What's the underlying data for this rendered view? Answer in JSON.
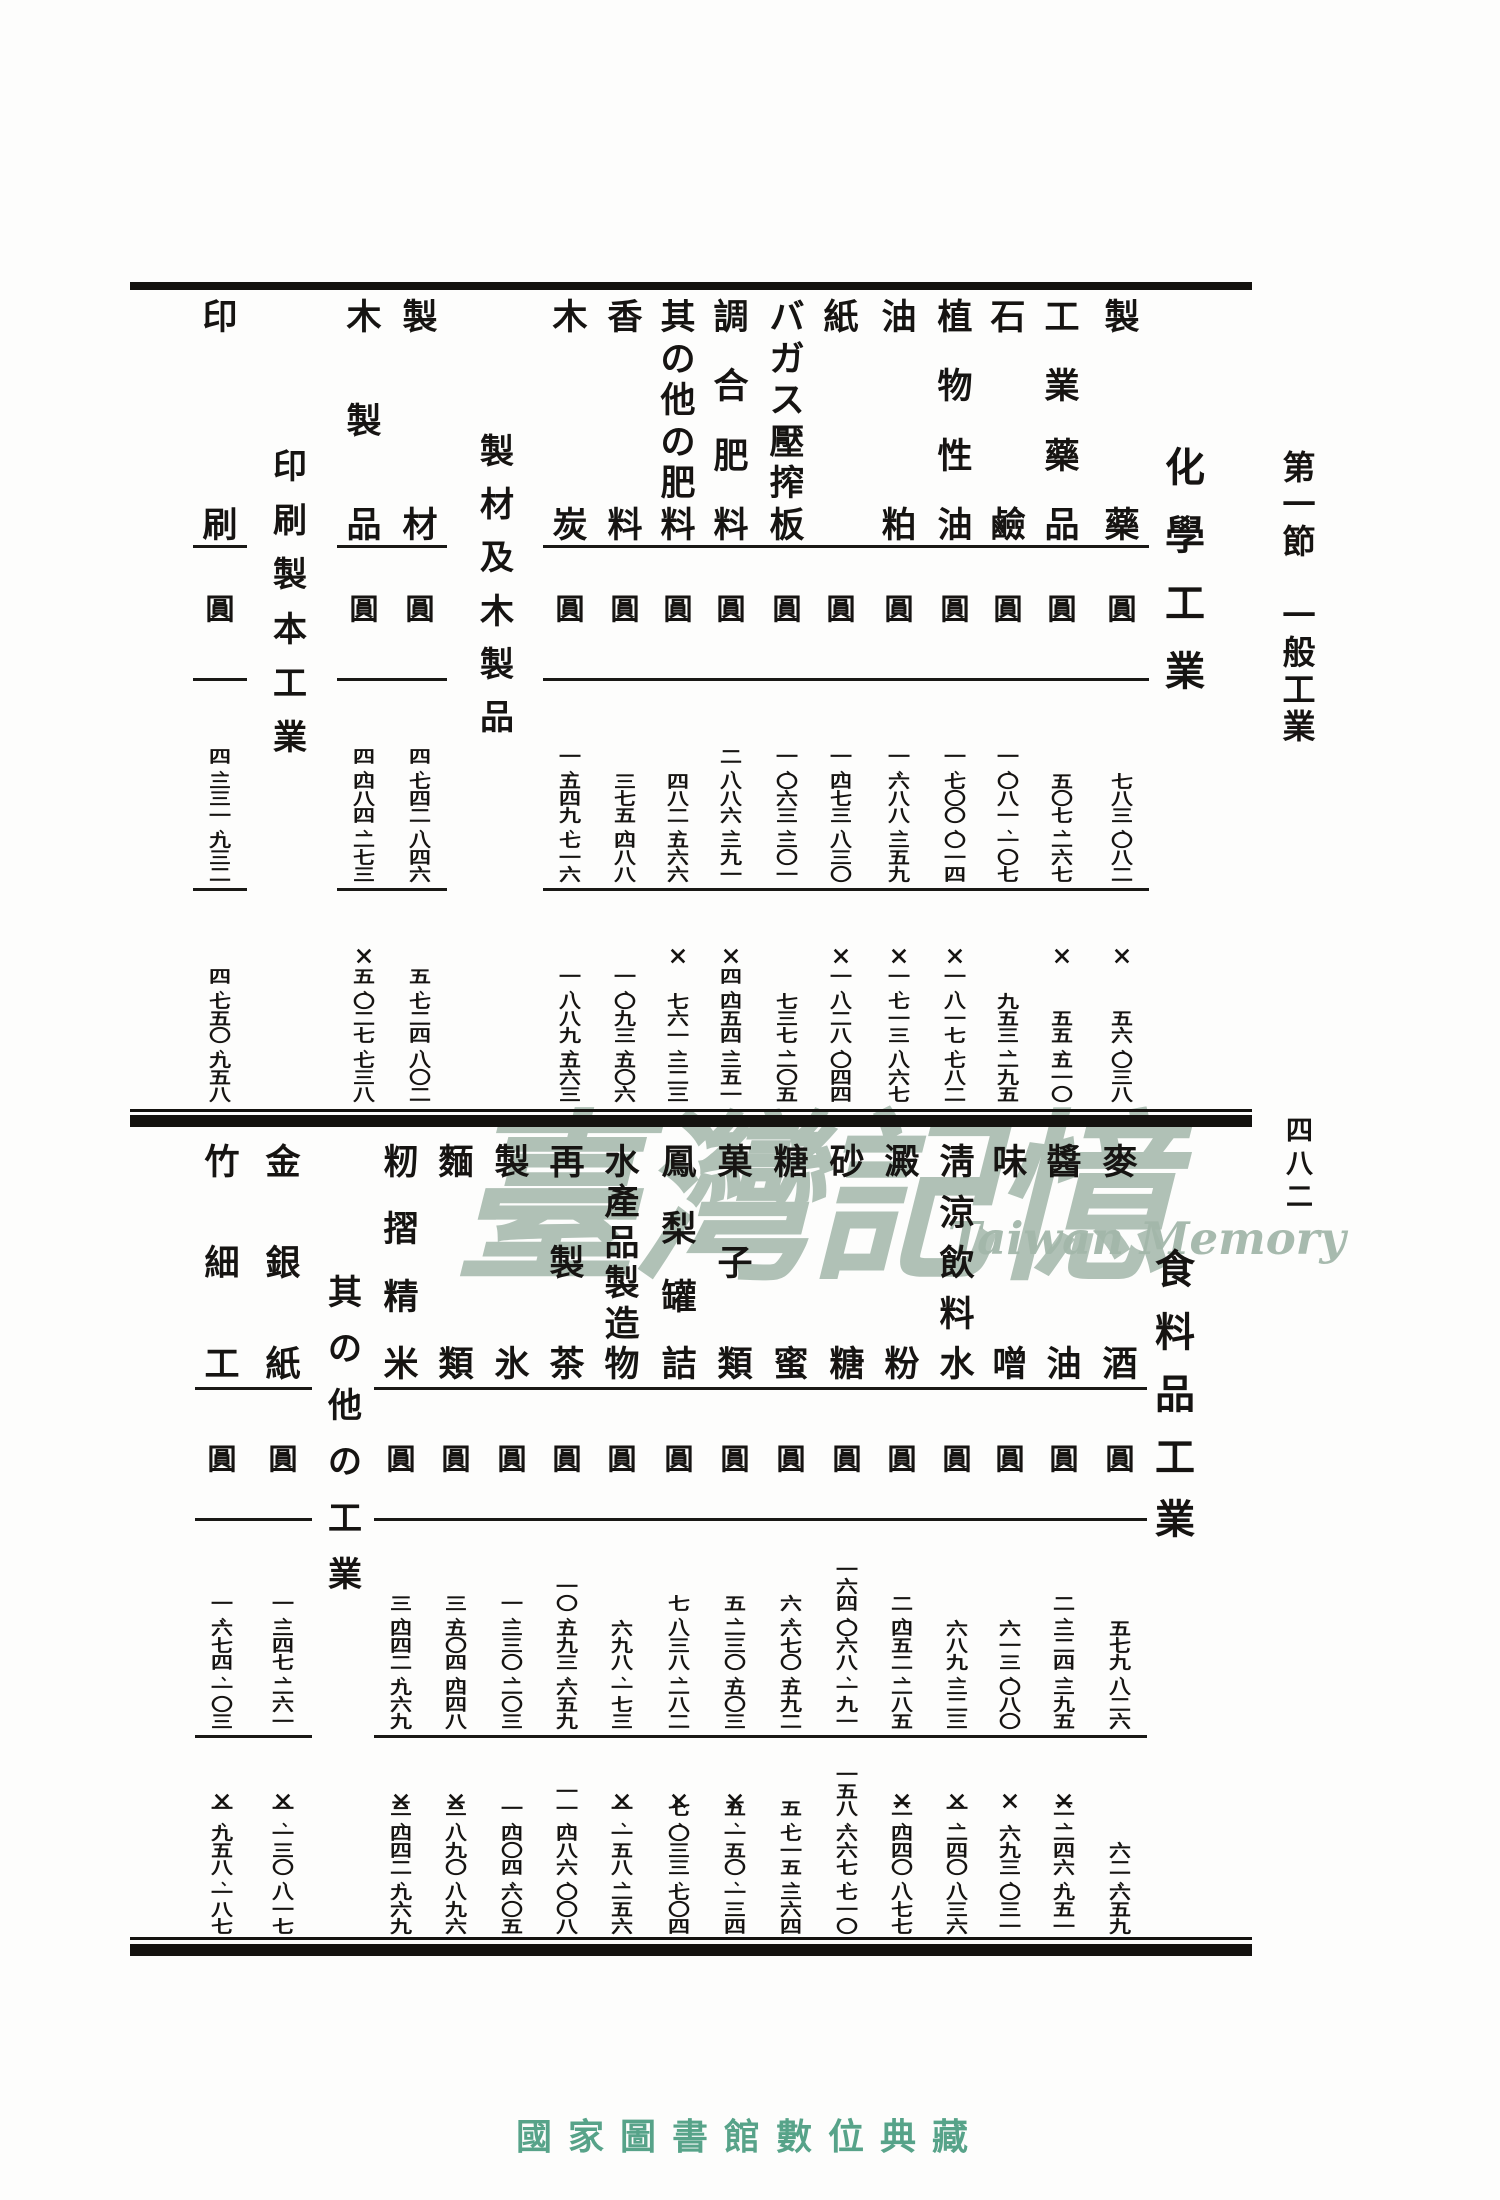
{
  "page": {
    "section_heading": "第一節　一般工業",
    "page_number": "四八二",
    "watermark": {
      "chars": "臺灣記憶",
      "latin": "Taiwan Memory"
    },
    "footer": "國家圖書館數位典藏",
    "unit": "圓",
    "x_symbol": "×",
    "accent_green": "#57a389",
    "watermark_green": "#a3b7aa"
  },
  "tables": [
    {
      "industry_label": "化學工業",
      "columns": [
        {
          "type": "data",
          "label": "製藥",
          "row1": "七八三、〇八二",
          "row2": "五六、〇三八",
          "row2_x": true
        },
        {
          "type": "data",
          "label": "工業藥品",
          "row1": "五〇七、二六七",
          "row2": "五五、五一〇",
          "row2_x": true
        },
        {
          "type": "data",
          "label": "石鹼",
          "row1": "一、〇八一、一〇七",
          "row2": "九五三、二九五",
          "row2_x": false
        },
        {
          "type": "data",
          "label": "植物性油",
          "row1": "一、七〇〇、〇一四",
          "row2": "一、八一七、七八二",
          "row2_x": true
        },
        {
          "type": "data",
          "label": "油粕",
          "row1": "一、六八八、三五九",
          "row2": "一、七一三、八六七",
          "row2_x": true
        },
        {
          "type": "data",
          "label": "紙",
          "row1": "一、四七三、八三〇",
          "row2": "一、八二八、〇四四",
          "row2_x": true
        },
        {
          "type": "data",
          "label": "バガス壓搾板",
          "row1": "一、〇六三、三〇一",
          "row2": "七三七、二〇五",
          "row2_x": false
        },
        {
          "type": "data",
          "label": "調合肥料",
          "row1": "二、八八六、三九一",
          "row2": "四、四五四、三五一",
          "row2_x": true
        },
        {
          "type": "data",
          "label": "其の他の肥料",
          "row1": "四八二、五六六",
          "row2": "七六一、三二三",
          "row2_x": true
        },
        {
          "type": "data",
          "label": "香料",
          "row1": "三七五、四八八",
          "row2": "一、〇九三、五〇六",
          "row2_x": false
        },
        {
          "type": "data",
          "label": "木炭",
          "row1": "一、五四九、七一六",
          "row2": "一、八八九、五六三",
          "row2_x": false
        },
        {
          "type": "group",
          "label": "製材及木製品"
        },
        {
          "type": "data",
          "label": "製材",
          "row1": "四、七四二、八四六",
          "row2": "五、七二四、八〇二",
          "row2_x": false
        },
        {
          "type": "data",
          "label": "木製品",
          "row1": "四、四八四、二七三",
          "row2": "五、〇二七、七三八",
          "row2_x": true
        },
        {
          "type": "group",
          "label": "印刷製本工業"
        },
        {
          "type": "data",
          "label": "印刷",
          "row1": "四、三三一、九三二",
          "row2": "四、七五〇、九五八",
          "row2_x": false
        }
      ]
    },
    {
      "industry_label": "食料品工業",
      "columns": [
        {
          "type": "data",
          "label": "麥酒",
          "row1": "五七九、八二六",
          "row2": "六二、六五九",
          "row2_x": false
        },
        {
          "type": "data",
          "label": "醬油",
          "row1": "二、三二四、三九五",
          "row2": "二、二四六、九五一",
          "row2_x": true
        },
        {
          "type": "data",
          "label": "味噌",
          "row1": "六一三、〇八〇",
          "row2": "六九三、〇三一",
          "row2_x": true
        },
        {
          "type": "data",
          "label": "淸涼飲料水",
          "row1": "六八九、三二三",
          "row2": "一、二四〇、八三六",
          "row2_x": true
        },
        {
          "type": "data",
          "label": "澱粉",
          "row1": "二、四五二、二八五",
          "row2": "二、四四〇、八七七",
          "row2_x": true
        },
        {
          "type": "data",
          "label": "砂糖",
          "row1": "一六四、〇六八、一九一",
          "row2": "一五八、六六七、七一〇",
          "row2_x": false
        },
        {
          "type": "data",
          "label": "糖蜜",
          "row1": "六、六七〇、五九二",
          "row2": "五、七一五、三六四",
          "row2_x": false
        },
        {
          "type": "data",
          "label": "菓子類",
          "row1": "五、二三〇、五〇三",
          "row2": "五、一五〇、一三四",
          "row2_x": true
        },
        {
          "type": "data",
          "label": "鳳梨罐詰",
          "row1": "七、八三八、二八二",
          "row2": "七、〇三三、七〇四",
          "row2_x": true
        },
        {
          "type": "data",
          "label": "水產品製造物",
          "row1": "六九八、一七三",
          "row2": "一、一五八、二五六",
          "row2_x": true
        },
        {
          "type": "data",
          "label": "再製茶",
          "row1": "一〇、五九三、六五九",
          "row2": "一一、四八六、〇〇八",
          "row2_x": false
        },
        {
          "type": "data",
          "label": "製氷",
          "row1": "一、三三〇、二〇三",
          "row2": "一、四〇四、六〇五",
          "row2_x": false
        },
        {
          "type": "data",
          "label": "麵類",
          "row1": "三、五〇四、四四八",
          "row2": "三、八九〇、八九六",
          "row2_x": true
        },
        {
          "type": "data",
          "label": "籾摺精米",
          "row1": "三、四四二、九六九",
          "row2": "三、四四二、九六九",
          "row2_x": true
        },
        {
          "type": "group",
          "label": "其の他の工業"
        },
        {
          "type": "data",
          "label": "金銀紙",
          "row1": "一、三四七、二六一",
          "row2": "一、一三〇、八一七",
          "row2_x": true
        },
        {
          "type": "data",
          "label": "竹細工",
          "row1": "一、六七四、一〇三",
          "row2": "一、九五八、一八七",
          "row2_x": true
        }
      ]
    }
  ]
}
